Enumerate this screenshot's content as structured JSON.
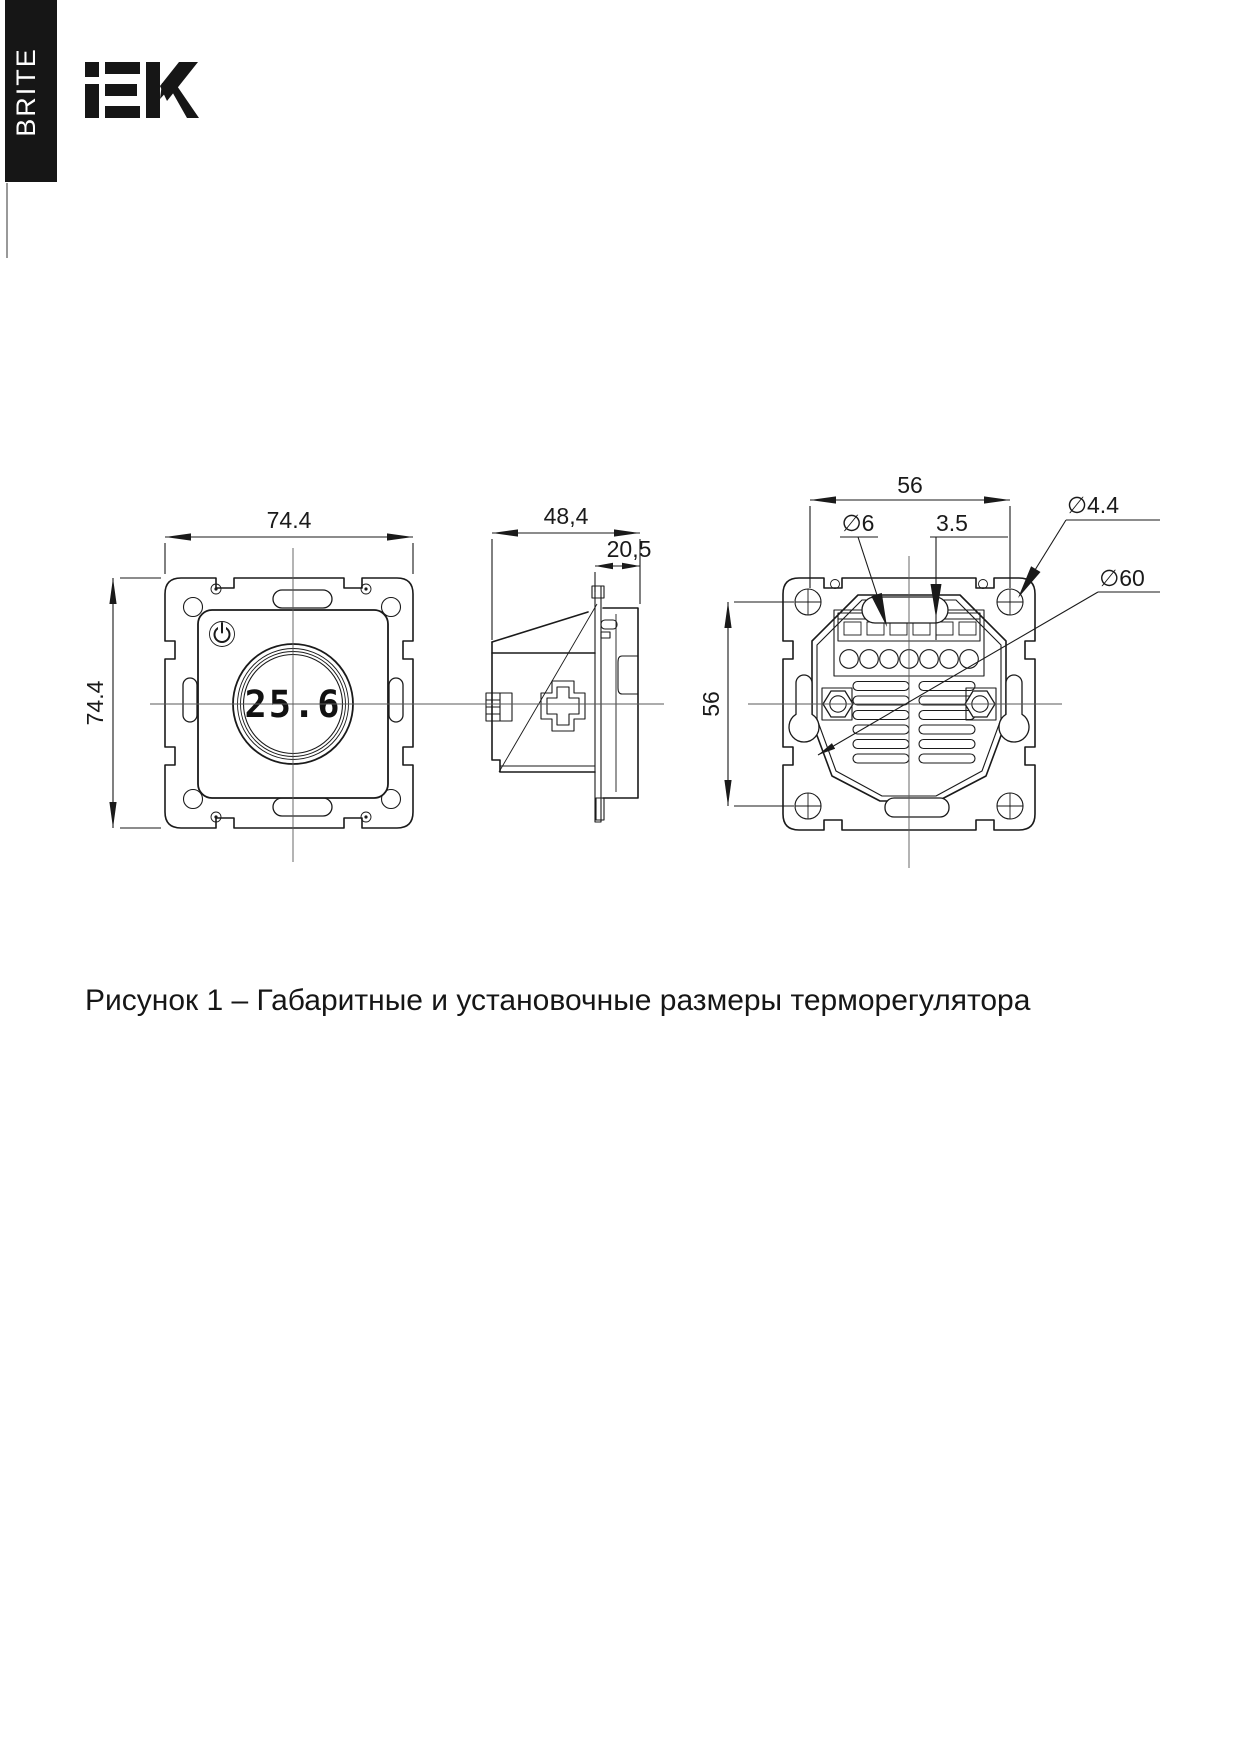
{
  "page": {
    "background": "#ffffff",
    "ink": "#1a1a1a"
  },
  "header": {
    "series_label": "BRITE",
    "logo_text": "iEK"
  },
  "figure": {
    "caption": "Рисунок 1 – Габаритные и установочные размеры терморегулятора",
    "front_view": {
      "width": "74.4",
      "height": "74.4",
      "display_reading": "25.6"
    },
    "side_view": {
      "total_depth": "48,4",
      "front_protrusion": "20,5"
    },
    "back_view": {
      "mount_hole_spacing_h": "56",
      "mount_hole_spacing_v": "56",
      "keyhole_dia": "∅6",
      "terminal_slot": "3.5",
      "screw_hole_dia": "∅4.4",
      "mechanism_dia": "∅60"
    }
  }
}
